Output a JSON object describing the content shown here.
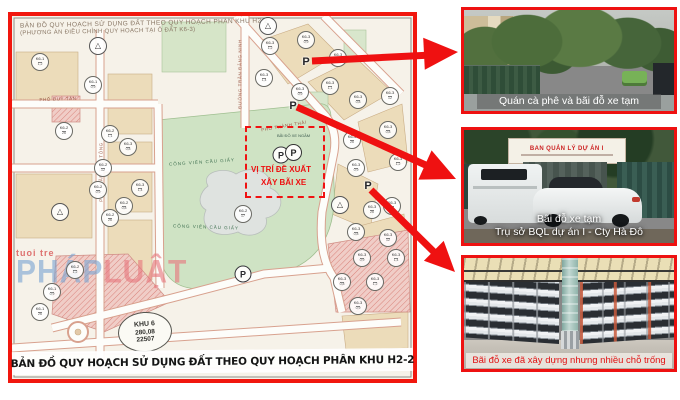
{
  "map": {
    "header_line1": "BẢN ĐỒ QUY HOẠCH SỬ DỤNG ĐẤT THEO QUY HOẠCH PHÂN KHU H2-2",
    "header_line2": "(PHƯƠNG ÁN ĐIỀU CHỈNH QUY HOẠCH TẠI Ô ĐẤT K6-3)",
    "bottom_title": "BẢN ĐỒ QUY HOẠCH SỬ DỤNG ĐẤT THEO QUY HOẠCH PHÂN KHU H2-2",
    "proposal_box": {
      "note": "BÃI ĐỖ XE NGẦM",
      "p": "P",
      "line1": "VỊ TRÍ ĐỀ XUẤT",
      "line2": "XÂY BÃI XE"
    },
    "stamp": [
      "KHU 6",
      "280,08",
      "22507"
    ],
    "watermark": {
      "small": "tuoi tre",
      "big_blue": "PHÁP",
      "big_red": "LUẬT"
    },
    "p_letter": "P",
    "streets": [
      {
        "t": "PHỐ DUY TÂN",
        "x": 58,
        "y": 99,
        "r": -2
      },
      {
        "t": "PHỐ TRẦN THÁI TÔNG",
        "x": 101,
        "y": 172,
        "r": -90
      },
      {
        "t": "ĐƯỜNG TRẦN ĐĂNG NINH",
        "x": 240,
        "y": 74,
        "r": -90
      },
      {
        "t": "PHỐ THÀNH THÁI",
        "x": 284,
        "y": 126,
        "r": -10
      }
    ],
    "park_labels": [
      {
        "t": "CÔNG VIÊN CẦU GIẤY",
        "x": 202,
        "y": 162,
        "r": -4
      },
      {
        "t": "CÔNG VIÊN CẦU GIẤY",
        "x": 206,
        "y": 227,
        "r": 2
      }
    ],
    "plot_circles": [
      [
        40,
        62,
        "K6-1",
        "1,2"
      ],
      [
        93,
        85,
        "K6-1",
        "0,9"
      ],
      [
        64,
        131,
        "K6-2",
        "26"
      ],
      [
        110,
        134,
        "K6-2",
        "1,1"
      ],
      [
        128,
        147,
        "K6-3",
        "0,8"
      ],
      [
        103,
        168,
        "K6-2",
        "12"
      ],
      [
        98,
        190,
        "K6-2",
        "0,9"
      ],
      [
        140,
        188,
        "K6-3",
        "1,4"
      ],
      [
        110,
        218,
        "K6-2",
        "26"
      ],
      [
        124,
        206,
        "K6-2",
        "0,8"
      ],
      [
        270,
        46,
        "K6-3",
        "1,2"
      ],
      [
        306,
        40,
        "K6-3",
        "0,9"
      ],
      [
        338,
        58,
        "K6-3",
        "26"
      ],
      [
        330,
        86,
        "K6-3",
        "1,1"
      ],
      [
        358,
        100,
        "K6-3",
        "0,8"
      ],
      [
        390,
        96,
        "K6-3",
        "12"
      ],
      [
        300,
        92,
        "K6-3",
        "0,9"
      ],
      [
        264,
        78,
        "K6-3",
        "1,4"
      ],
      [
        352,
        140,
        "K6-3",
        "26"
      ],
      [
        388,
        130,
        "K6-3",
        "0,8"
      ],
      [
        398,
        162,
        "K6-3",
        "1,2"
      ],
      [
        356,
        168,
        "K6-3",
        "0,9"
      ],
      [
        372,
        210,
        "K6-3",
        "26"
      ],
      [
        392,
        206,
        "K6-3",
        "1,1"
      ],
      [
        356,
        232,
        "K6-3",
        "0,8"
      ],
      [
        388,
        238,
        "K6-3",
        "12"
      ],
      [
        362,
        258,
        "K6-3",
        "0,9"
      ],
      [
        396,
        258,
        "K6-3",
        "1,4"
      ],
      [
        243,
        214,
        "K6-2",
        "17"
      ],
      [
        75,
        270,
        "K6-2",
        "1,2"
      ],
      [
        52,
        292,
        "K6-1",
        "0,9"
      ],
      [
        40,
        312,
        "K6-1",
        "26"
      ],
      [
        342,
        282,
        "K6-3",
        "0,8"
      ],
      [
        375,
        282,
        "K6-3",
        "1,2"
      ],
      [
        358,
        306,
        "K6-3",
        "0,9"
      ],
      [
        98,
        46,
        "△",
        ""
      ],
      [
        340,
        205,
        "△",
        ""
      ],
      [
        60,
        212,
        "△",
        ""
      ],
      [
        268,
        26,
        "△",
        ""
      ]
    ],
    "p_marks": [
      [
        306,
        62
      ],
      [
        293,
        106
      ],
      [
        368,
        186
      ]
    ],
    "p_circles": [
      [
        281,
        155
      ],
      [
        243,
        274
      ]
    ]
  },
  "photos": [
    {
      "caption": "Quán cà phê và bãi đỗ xe tạm"
    },
    {
      "caption1": "Bãi đỗ xe tạm",
      "caption2": "Trụ sở BQL dự án I - Cty Hà Đô",
      "sign": "BAN QUẢN LÝ DỰ ÁN I"
    },
    {
      "caption": "Bãi đỗ xe đã xây dựng nhưng nhiều chỗ trống"
    }
  ],
  "colors": {
    "accent_red": "#ee1111",
    "map_border": "#f1170e",
    "caption_red": "#e01212",
    "park_green": "#cfe3c4",
    "paper": "#f6f2e9"
  }
}
